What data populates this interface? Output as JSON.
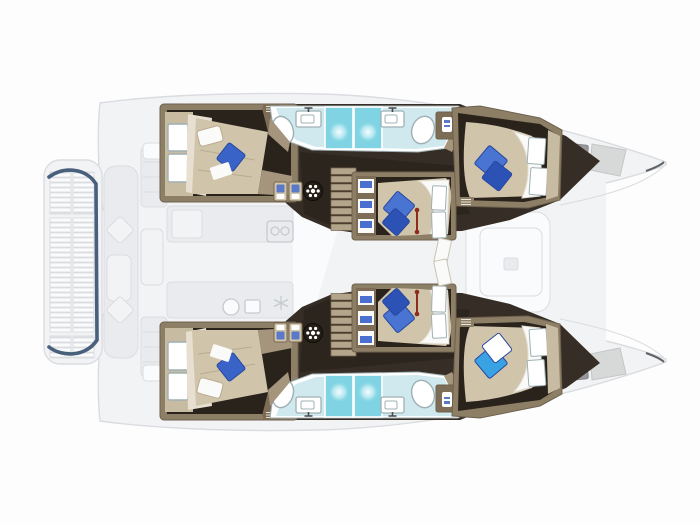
{
  "meta": {
    "description": "Top-down deck and cabin layout plan of a sailing catamaran, bow facing right; lower-deck accommodation drawn in solid colour over a faded upper-deck plan",
    "view": "floor-plan"
  },
  "palette": {
    "bg": "#fdfdfd",
    "ghost_fill": "#f2f3f5",
    "ghost_mid": "#e9ebee",
    "ghost_white": "#fafbfc",
    "ghost_line": "#dadce0",
    "ghost_dark": "#c7cacd",
    "navy": "#3a5472",
    "hatch_dark": "#97999d",
    "hatch_light": "#d7d9d8",
    "wall": "#8d7e66",
    "wall_dark": "#6f614e",
    "wall_light": "#c7bba2",
    "floor": "#362e26",
    "floor_dark": "#2a231c",
    "mattress": "#d0c4ab",
    "mattress_shade": "#b9ab8f",
    "headboard": "#e7e0d0",
    "sheet": "#fafaf8",
    "white": "#ffffff",
    "pillow_light": "#4a74d2",
    "pillow_mid": "#3a63c8",
    "pillow_dark": "#2b52b4",
    "pillow_edge": "#27479f",
    "pillow_bright": "#39a2e3",
    "bath_floor": "#cfe9ef",
    "shower": "#7fd3e2",
    "fixture_line": "#9fb0b4",
    "step": "#b3a58c",
    "step_gap": "#77664f",
    "cabinet": "#7d6d56",
    "counter_edge": "#a4957c",
    "red": "#8d2c1e",
    "icon_dark": "#241e17"
  },
  "legend": {
    "hulls": 2,
    "cabins": [
      {
        "id": "port-aft-cabin",
        "bed": "double",
        "pillows": [
          "white",
          "blue"
        ]
      },
      {
        "id": "port-mid-cabin",
        "bed": "double",
        "pillows": [
          "blue",
          "blue"
        ]
      },
      {
        "id": "port-forward-cabin",
        "bed": "double",
        "pillows": [
          "blue",
          "blue"
        ]
      },
      {
        "id": "starboard-aft-cabin",
        "bed": "double",
        "pillows": [
          "white",
          "blue"
        ]
      },
      {
        "id": "starboard-mid-cabin",
        "bed": "double",
        "pillows": [
          "blue",
          "blue"
        ]
      },
      {
        "id": "starboard-forward-cabin",
        "bed": "double",
        "pillows": [
          "bright-blue",
          "white"
        ]
      }
    ],
    "bathrooms": [
      {
        "id": "port-bathroom",
        "fixtures": [
          "toilet",
          "sink",
          "shower",
          "shower",
          "sink",
          "toilet",
          "locker"
        ]
      },
      {
        "id": "starboard-bathroom",
        "fixtures": [
          "toilet",
          "sink",
          "shower",
          "shower",
          "sink",
          "toilet",
          "locker"
        ]
      }
    ],
    "deck_features": [
      "stern-platform-louvers",
      "aft-cockpit-bench",
      "galley-counters",
      "saloon-table",
      "companionway-stairs",
      "bow-deck-hatches"
    ],
    "icons": [
      "hatch-wheel-icon",
      "storage-locker-icon",
      "stove-icon",
      "snowflake-icon",
      "galley-sink-icon",
      "bathroom-cabinet-icon"
    ]
  }
}
